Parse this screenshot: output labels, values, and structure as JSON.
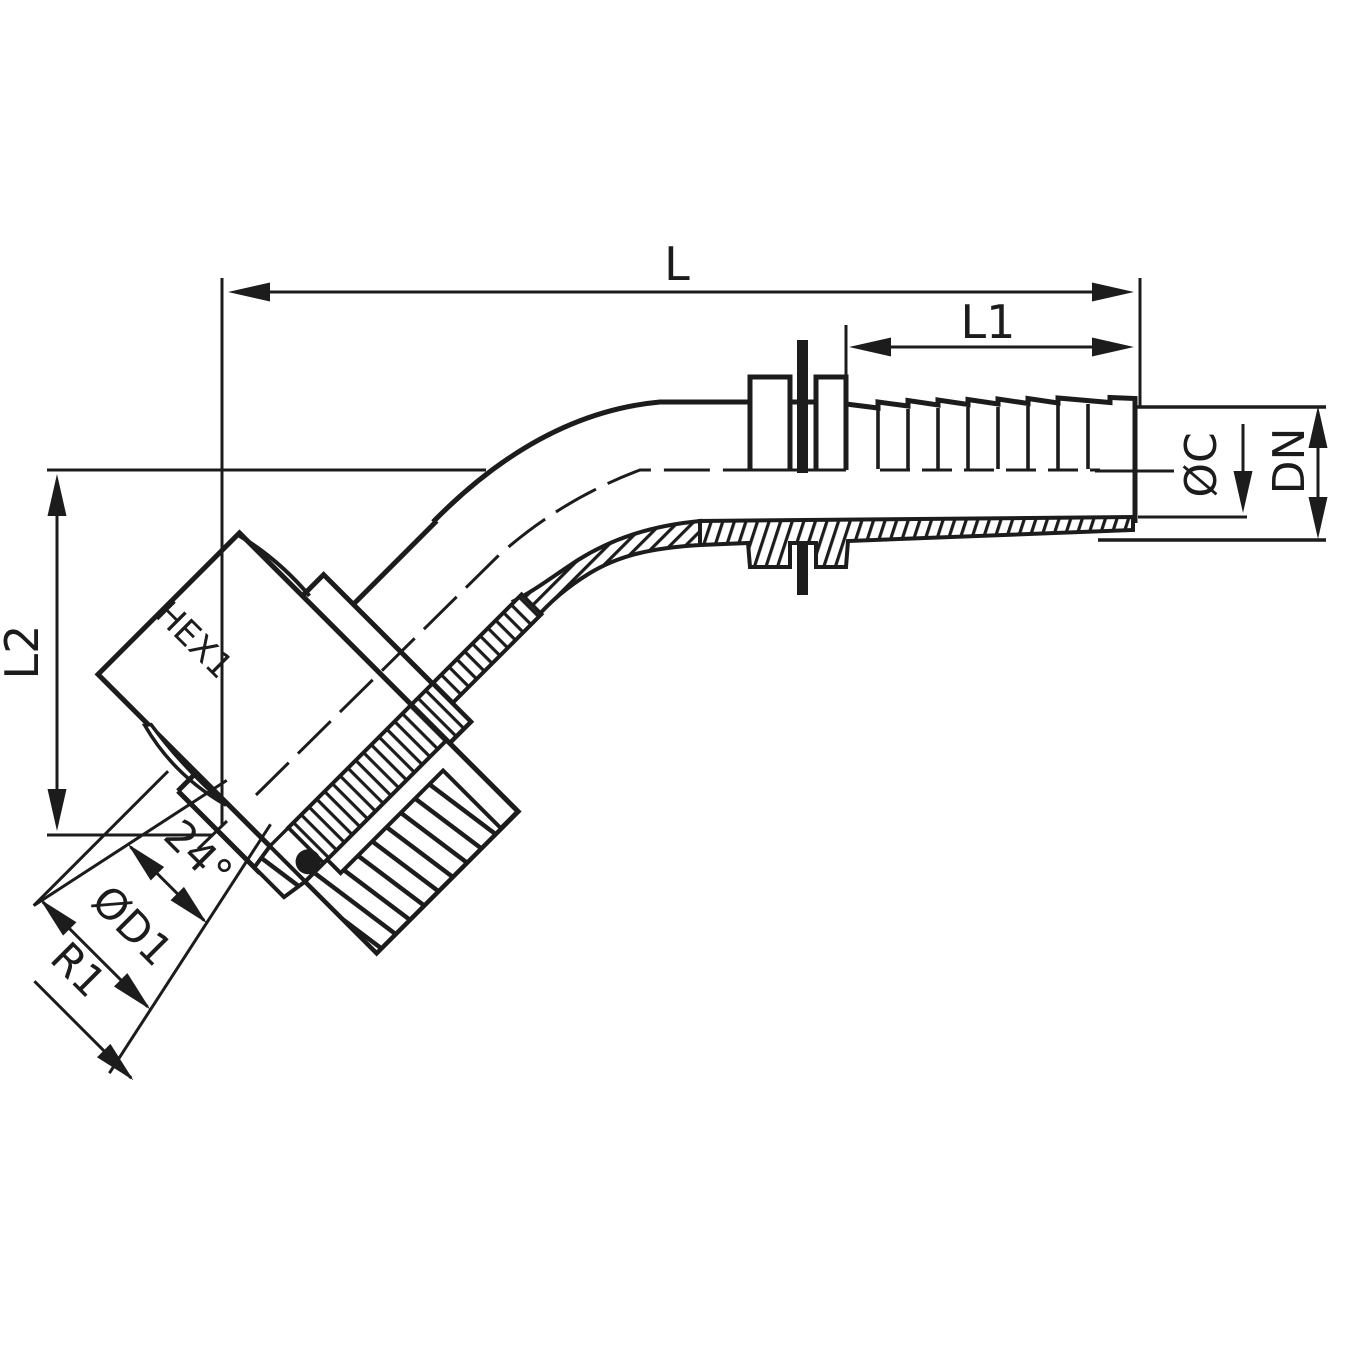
{
  "diagram": {
    "type": "technical-drawing",
    "subject": "45-degree elbow hose fitting with 24-degree cone swivel nut, half-section view",
    "background_color": "#ffffff",
    "line_color": "#1c1c1c",
    "dimensions": {
      "overall_length": "L",
      "tail_length": "L1",
      "elbow_height": "L2",
      "hex_size": "HEX1",
      "cone_angle": "24°",
      "cone_diameter": "ØD1",
      "thread": "R1",
      "tail_diameter": "ØC",
      "nominal_diameter": "DN"
    }
  }
}
